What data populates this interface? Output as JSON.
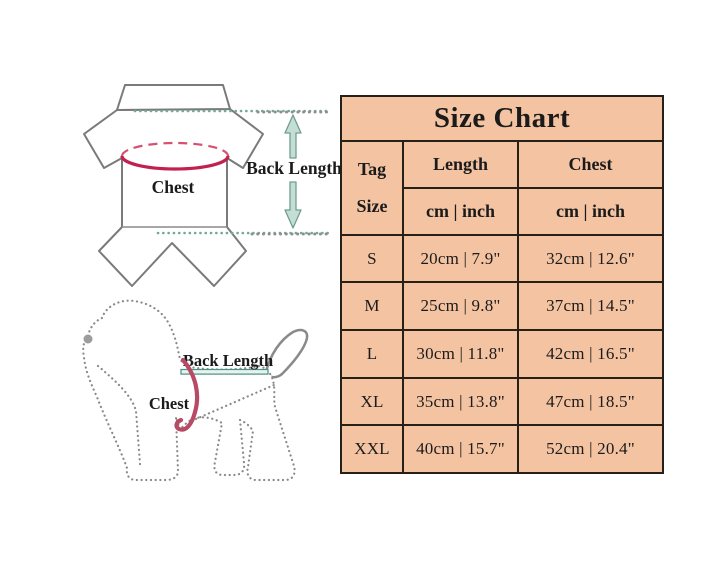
{
  "table": {
    "title": "Size Chart",
    "tag_line1": "Tag",
    "tag_line2": "Size",
    "col_length": "Length",
    "col_chest": "Chest",
    "unit": "cm | inch",
    "rows": [
      {
        "tag": "S",
        "length": "20cm | 7.9\"",
        "chest": "32cm | 12.6\""
      },
      {
        "tag": "M",
        "length": "25cm | 9.8\"",
        "chest": "37cm | 14.5\""
      },
      {
        "tag": "L",
        "length": "30cm | 11.8\"",
        "chest": "42cm | 16.5\""
      },
      {
        "tag": "XL",
        "length": "35cm | 13.8\"",
        "chest": "47cm | 18.5\""
      },
      {
        "tag": "XXL",
        "length": "40cm | 15.7\"",
        "chest": "52cm | 20.4\""
      }
    ]
  },
  "diagrams": {
    "garment": {
      "chest_label": "Chest",
      "back_length_label": "Back Length"
    },
    "dog": {
      "chest_label": "Chest",
      "back_length_label": "Back Length"
    }
  },
  "colors": {
    "table_bg": "#f4c4a2",
    "table_border": "#262019",
    "measure_red": "#c2204e",
    "measure_teal": "#6f9e91",
    "outline_gray": "#7a7a7a"
  },
  "chart_data": {
    "type": "table",
    "title": "Size Chart",
    "columns": [
      "Tag Size",
      "Length (cm | inch)",
      "Chest (cm | inch)"
    ],
    "rows": [
      [
        "S",
        "20cm | 7.9\"",
        "32cm | 12.6\""
      ],
      [
        "M",
        "25cm | 9.8\"",
        "37cm | 14.5\""
      ],
      [
        "L",
        "30cm | 11.8\"",
        "42cm | 16.5\""
      ],
      [
        "XL",
        "35cm | 13.8\"",
        "47cm | 18.5\""
      ],
      [
        "XXL",
        "40cm | 15.7\"",
        "52cm | 20.4\""
      ]
    ]
  }
}
